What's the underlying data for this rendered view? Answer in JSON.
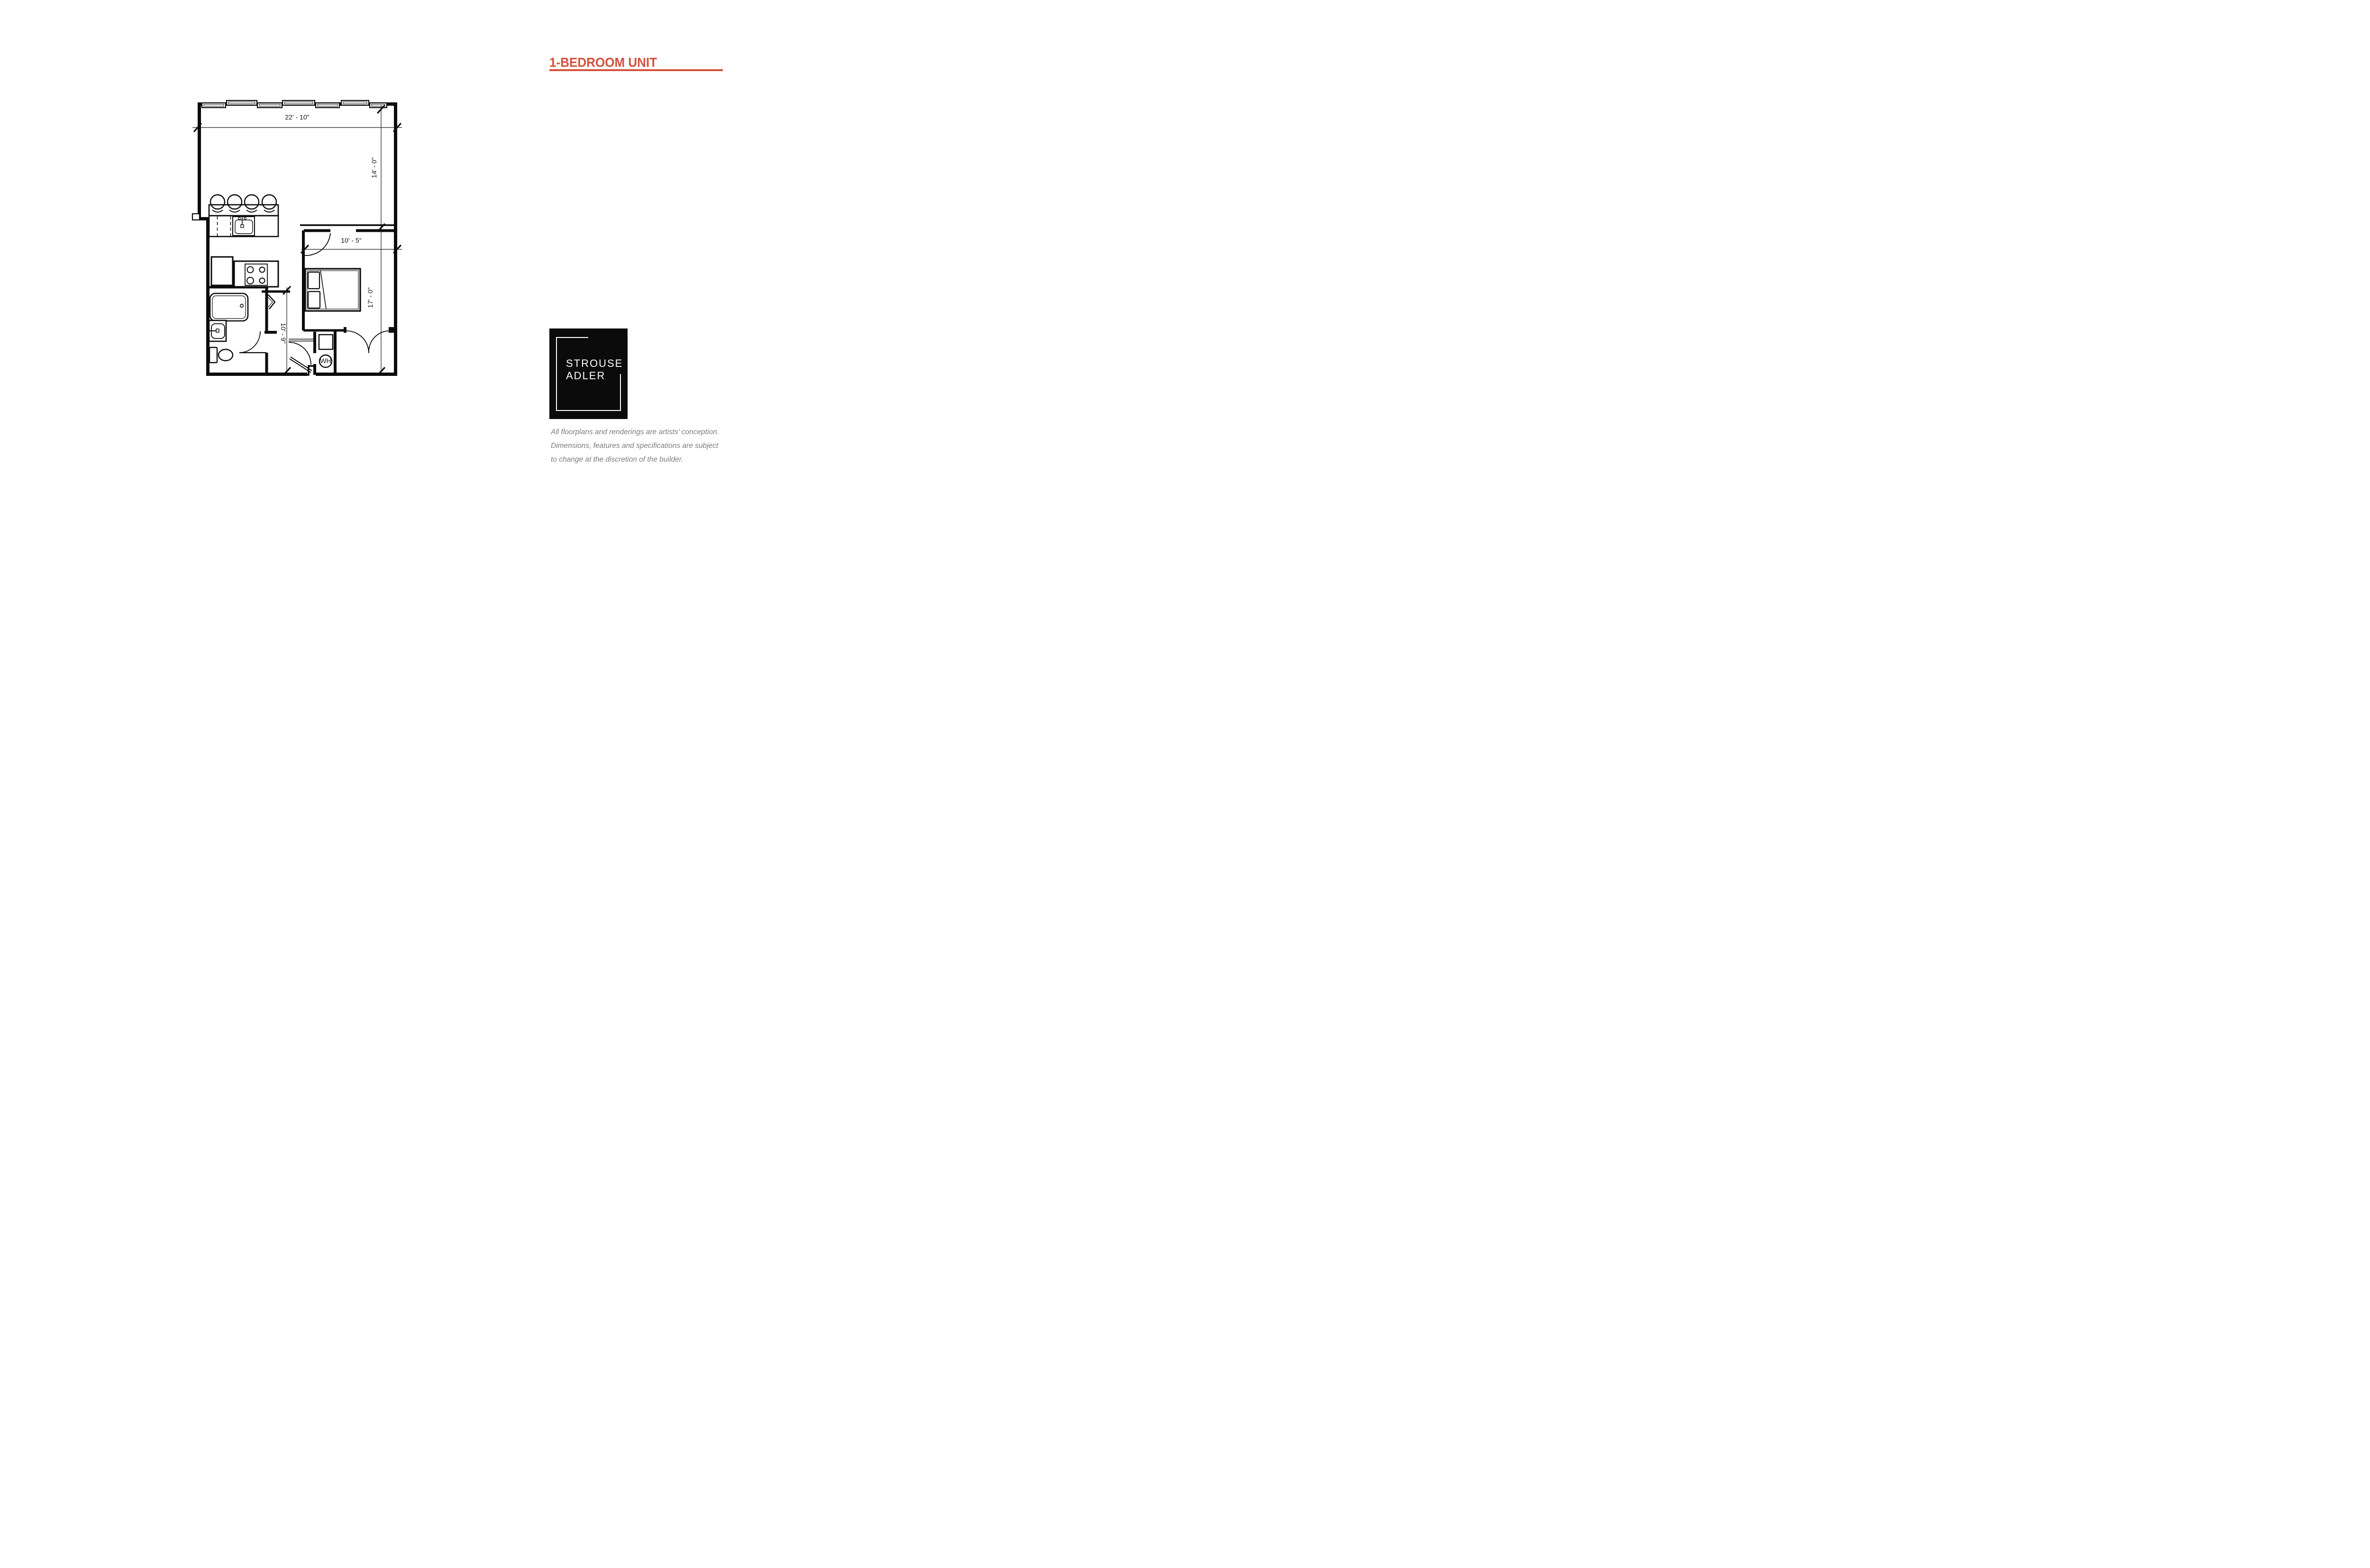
{
  "accent_color": "#d6503c",
  "title": {
    "text": "1-BEDROOM UNIT"
  },
  "floorplan": {
    "dimensions": {
      "living_width": "22' - 10\"",
      "living_depth": "14' - 0\"",
      "bedroom_width": "10' - 5\"",
      "bedroom_depth": "17' - 0\"",
      "hall_length": "10' - 9\"",
      "water_heater_label": "WH"
    }
  },
  "logo": {
    "line1": "STROUSE",
    "line2": "ADLER"
  },
  "disclaimer": {
    "lines": [
      "All floorplans and renderings are artists’ conception.",
      "Dimensions, features and specifications are subject",
      "to change at the discretion of the builder."
    ]
  }
}
